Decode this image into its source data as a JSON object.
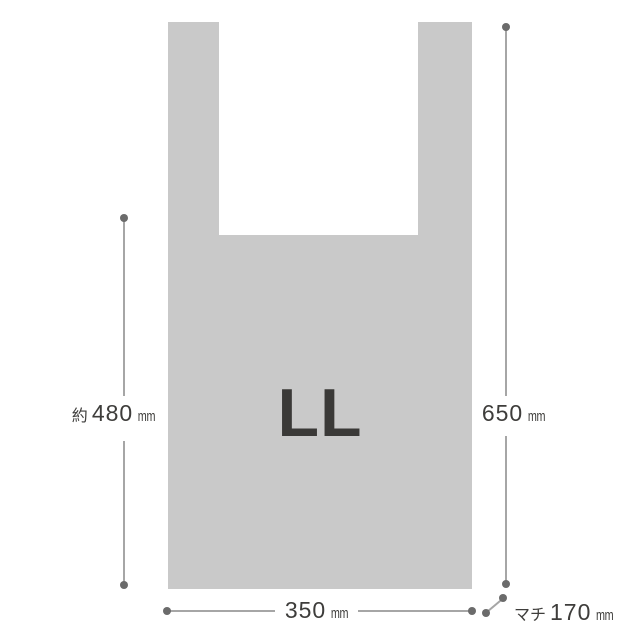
{
  "colors": {
    "background": "#ffffff",
    "bag_fill": "#c9c9c9",
    "size_text": "#3a3937",
    "dim_text": "#3e3d3b",
    "line": "#a6a6a6",
    "dot": "#6b6b6b"
  },
  "bag": {
    "size_label": "LL"
  },
  "annotations": {
    "left_height": {
      "prefix": "約",
      "value": "480",
      "unit": "mm"
    },
    "right_height": {
      "prefix": "",
      "value": "650",
      "unit": "mm"
    },
    "bottom_width": {
      "prefix": "",
      "value": "350",
      "unit": "mm"
    },
    "gusset": {
      "prefix": "マチ",
      "value": "170",
      "unit": "mm"
    }
  }
}
